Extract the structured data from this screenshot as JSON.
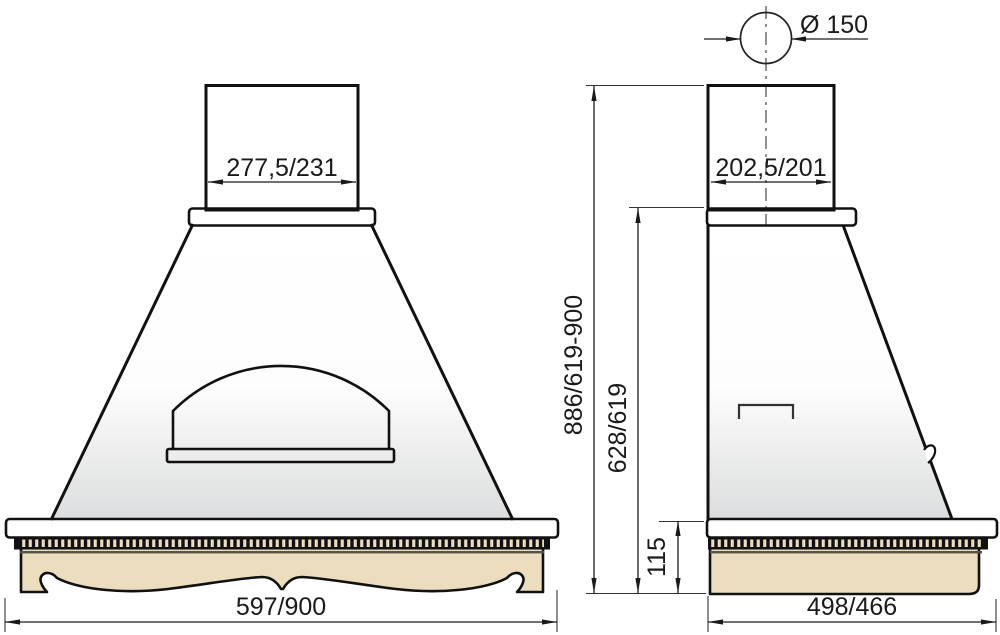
{
  "dims": {
    "front_chimney_width": "277,5/231",
    "front_base_width": "597/900",
    "duct_diameter": "Ø 150",
    "side_chimney_depth": "202,5/201",
    "overall_height": "886/619-900",
    "hood_body_height": "628/619",
    "base_trim_height": "115",
    "side_base_depth": "498/466"
  },
  "colors": {
    "wood": "#ECDDBE",
    "outline": "#111111",
    "dimension": "#1a1a1a",
    "dentil_dark": "#111111",
    "molding_shadow": "#56524A"
  }
}
